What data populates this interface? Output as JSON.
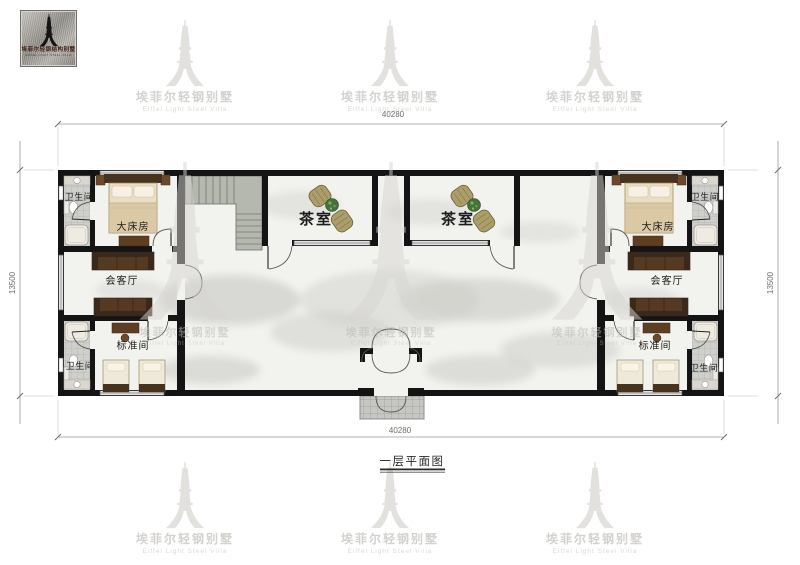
{
  "logo": {
    "chinese": "埃菲尔轻钢结构别墅",
    "english": "EIFFEL LIGHT STEEL VILLA"
  },
  "watermark": {
    "chinese": "埃菲尔轻钢别墅",
    "english": "Eiffel Light Steel Villa"
  },
  "plan": {
    "caption": "一层平面图",
    "dimensions": {
      "top": "40280",
      "bottom": "40280",
      "left": "13500",
      "right": "13500"
    },
    "rooms": [
      {
        "id": "bath-top-left",
        "label": "卫生间"
      },
      {
        "id": "king-room-left",
        "label": "大床房"
      },
      {
        "id": "living-left",
        "label": "会客厅"
      },
      {
        "id": "standard-left",
        "label": "标准间"
      },
      {
        "id": "bath-bottom-left",
        "label": "卫生间"
      },
      {
        "id": "tea-room-1",
        "label": "茶室"
      },
      {
        "id": "tea-room-2",
        "label": "茶室"
      },
      {
        "id": "king-room-right",
        "label": "大床房"
      },
      {
        "id": "bath-top-right",
        "label": "卫生间"
      },
      {
        "id": "living-right",
        "label": "会客厅"
      },
      {
        "id": "standard-right",
        "label": "标准间"
      },
      {
        "id": "bath-bottom-right",
        "label": "卫生间"
      }
    ],
    "colors": {
      "wall": "#141414",
      "wood": "#5d4024",
      "marble_floor": "#f2f2ef",
      "bath_tile": "#cfcfcb",
      "plant": "#47703a",
      "stair": "#b4b8ae"
    }
  }
}
